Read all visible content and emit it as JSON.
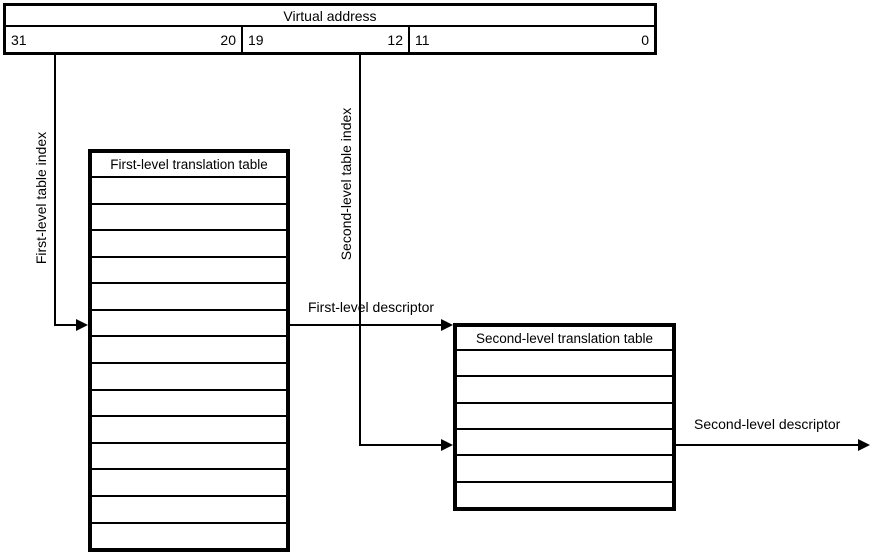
{
  "virtual_address": {
    "title": "Virtual address",
    "fields": [
      {
        "high_bit": "31",
        "low_bit": "20"
      },
      {
        "high_bit": "19",
        "low_bit": "12"
      },
      {
        "high_bit": "11",
        "low_bit": "0"
      }
    ]
  },
  "connectors": {
    "first_level_index_label": "First-level table index",
    "second_level_index_label": "Second-level table index",
    "first_level_descriptor_label": "First-level descriptor",
    "second_level_descriptor_label": "Second-level descriptor"
  },
  "first_level_table": {
    "title": "First-level translation table",
    "row_count": 14
  },
  "second_level_table": {
    "title": "Second-level translation table",
    "row_count": 6
  },
  "colors": {
    "line": "#000000",
    "background": "#ffffff"
  }
}
